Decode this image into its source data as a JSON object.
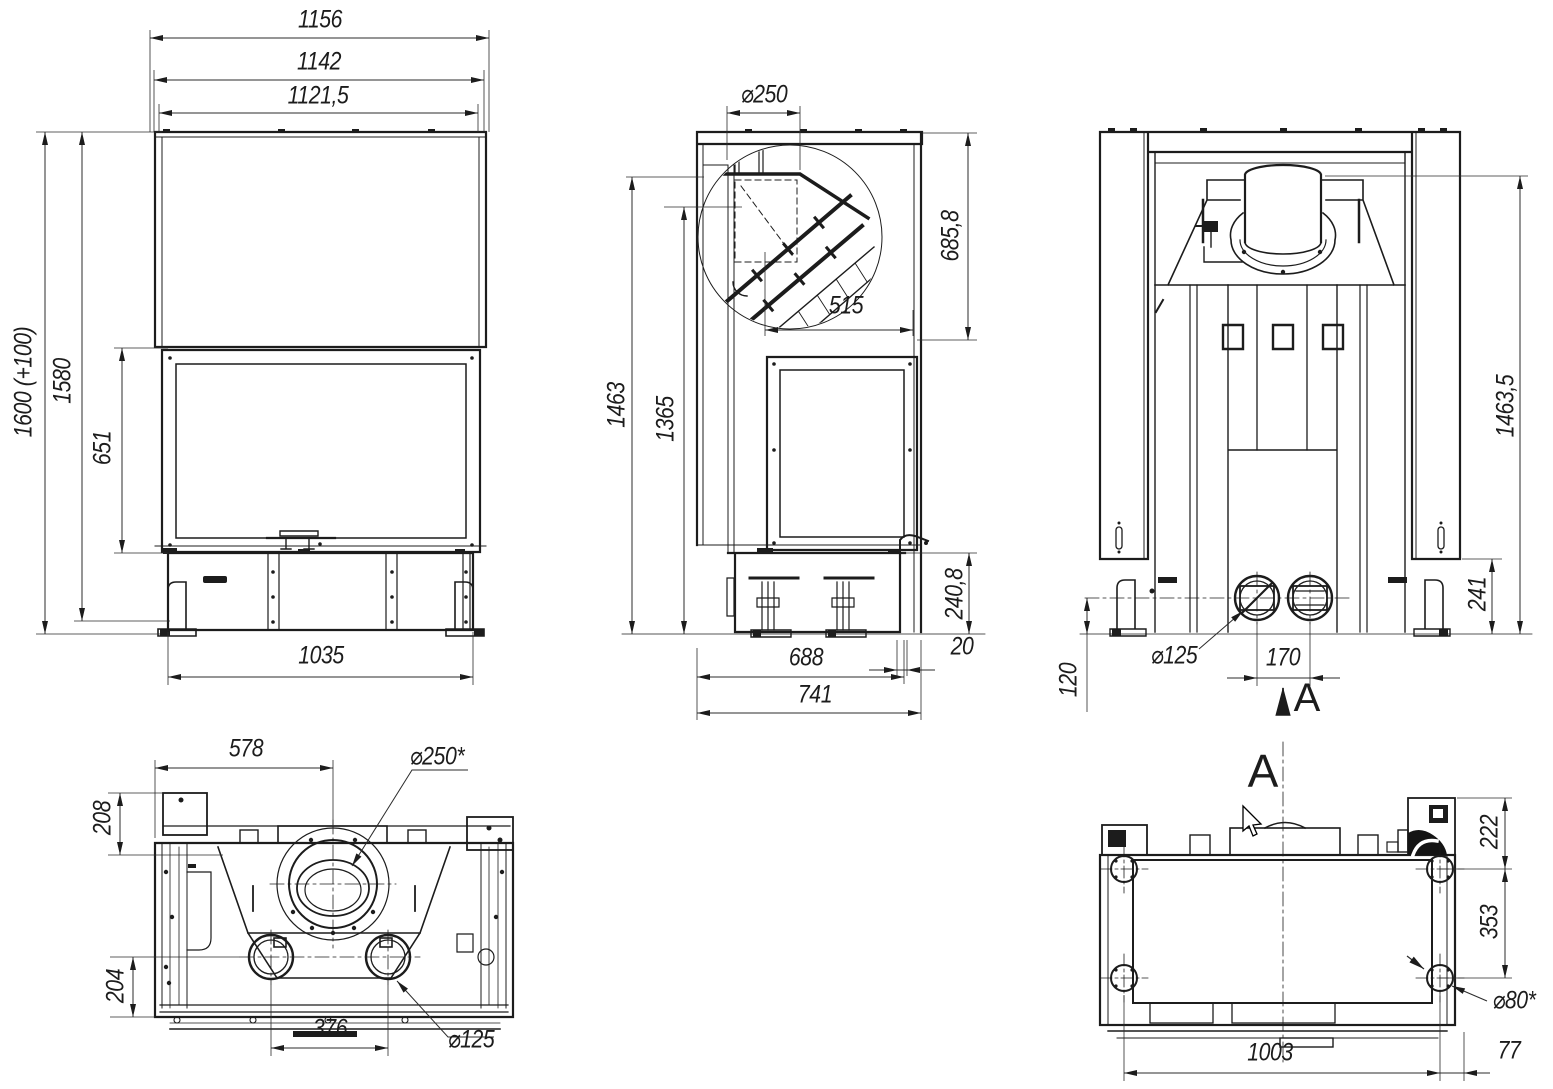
{
  "theme": {
    "paper": "#ffffff",
    "ink": "#1c1c1c",
    "dim_ink": "#2b2b2b"
  },
  "views": {
    "front": {
      "width_overall": "1156",
      "width_body": "1142",
      "width_inner": "1121,5",
      "height_overall": "1600 (+100)",
      "height_body": "1580",
      "glass_height": "651",
      "base_width": "1035"
    },
    "side": {
      "flue_diameter": "⌀250",
      "top_depth": "685,8",
      "chamber_depth": "515",
      "height_to_top": "1463",
      "height_to_damper": "1365",
      "plinth_height": "240,8",
      "rear_gap": "20",
      "depth_body": "688",
      "depth_overall": "741"
    },
    "rear": {
      "height_to_collar": "1463,5",
      "plinth_height": "241",
      "intake_height": "120",
      "intake_diameter": "⌀125",
      "intake_spacing": "170",
      "section_arrow": "A"
    },
    "top": {
      "flue_offset": "578",
      "flue_diameter": "⌀250*",
      "rear_offset": "208",
      "front_offset": "204",
      "intake_spacing": "376",
      "intake_diameter": "⌀125"
    },
    "bottom": {
      "view_label": "A",
      "foot_rear_offset": "222",
      "foot_depth_spacing": "353",
      "foot_diameter": "⌀80*",
      "foot_width_spacing": "1003",
      "foot_side_offset": "77"
    }
  }
}
